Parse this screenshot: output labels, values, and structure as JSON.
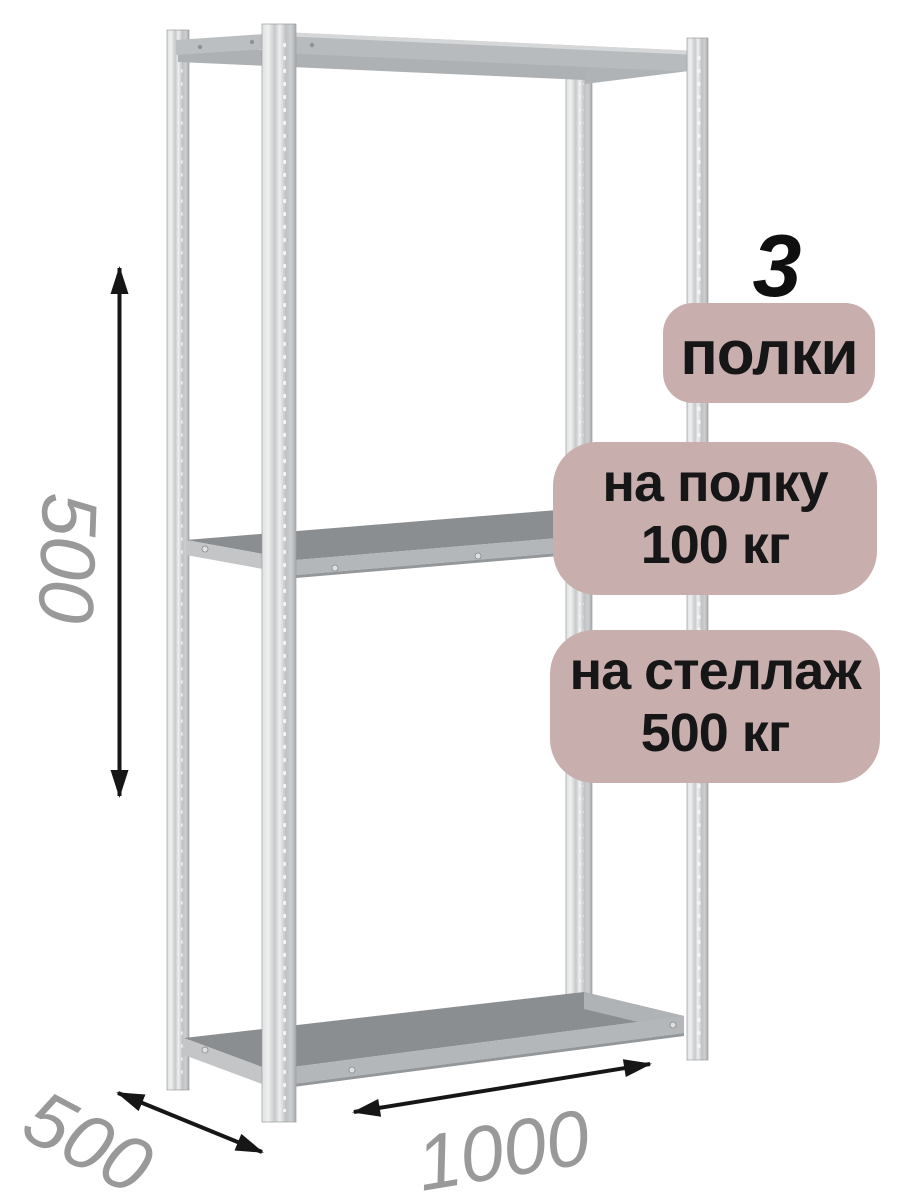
{
  "product_annotations": {
    "shelf_count": {
      "value": "3",
      "label": "полки"
    },
    "per_shelf_capacity": {
      "line1": "на полку",
      "line2": "100 кг"
    },
    "per_rack_capacity": {
      "line1": "на стеллаж",
      "line2": "500 кг"
    }
  },
  "dimensions": {
    "section_height_mm": "500",
    "depth_mm": "500",
    "width_mm": "1000"
  },
  "colors": {
    "badge_background": "#c9aeae",
    "badge_text": "#161616",
    "dimension_text": "#999999",
    "arrow": "#161616",
    "metal_light": "#dfe0e1",
    "metal_mid": "#c2c4c6",
    "metal_dark": "#a8abad",
    "shelf_surface": "#8b8e90"
  }
}
